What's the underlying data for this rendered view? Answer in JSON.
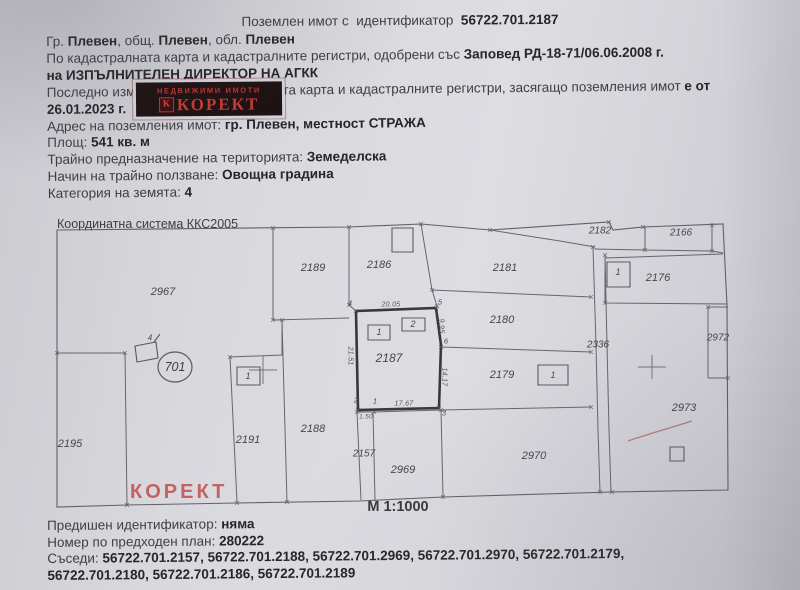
{
  "title": {
    "segments": [
      {
        "t": "Поземлен имот с  идентификатор  ",
        "b": false
      },
      {
        "t": "56722.701.2187",
        "b": true
      }
    ]
  },
  "doc": {
    "lines": [
      [
        {
          "t": "Гр. ",
          "b": false
        },
        {
          "t": "Плевен",
          "b": true
        },
        {
          "t": ", общ. ",
          "b": false
        },
        {
          "t": "Плевен",
          "b": true
        },
        {
          "t": ", обл. ",
          "b": false
        },
        {
          "t": "Плевен",
          "b": true
        }
      ],
      [
        {
          "t": "По кадастралната карта и кадастралните регистри, одобрени със ",
          "b": false
        },
        {
          "t": "Заповед РД-18-71/06.06.2008 г.",
          "b": true
        }
      ],
      [
        {
          "t": "на ИЗПЪЛНИТЕЛЕН ДИРЕКТОР НА АГКК",
          "b": true
        }
      ],
      [
        {
          "t": "Последно изменение на кадастралната карта и кадастралните регистри, засягащо поземления имот ",
          "b": false
        },
        {
          "t": "е от",
          "b": true
        }
      ],
      [
        {
          "t": "26.01.2023 г.",
          "b": true
        }
      ],
      [
        {
          "t": "Адрес на поземления имот: ",
          "b": false
        },
        {
          "t": "гр. Плевен, местност СТРАЖА",
          "b": true
        }
      ],
      [
        {
          "t": "Площ: ",
          "b": false
        },
        {
          "t": "541 кв. м",
          "b": true
        }
      ],
      [
        {
          "t": "Трайно предназначение на територията: ",
          "b": false
        },
        {
          "t": "Земеделска",
          "b": true
        }
      ],
      [
        {
          "t": "Начин на трайно ползване: ",
          "b": false
        },
        {
          "t": "Овощна градина",
          "b": true
        }
      ],
      [
        {
          "t": "Категория на земята: ",
          "b": false
        },
        {
          "t": "4",
          "b": true
        }
      ]
    ]
  },
  "logo": {
    "tagline": "НЕДВИЖИМИ ИМОТИ",
    "brand": "КОРЕКТ",
    "monogram": "К"
  },
  "map": {
    "coord_system": "Координатна система ККС2005",
    "scale_label": "М 1:1000",
    "watermark": "КОРЕКТ",
    "region_number": "701",
    "parcels": [
      {
        "id": "2967"
      },
      {
        "id": "2189"
      },
      {
        "id": "2186"
      },
      {
        "id": "2181"
      },
      {
        "id": "2182"
      },
      {
        "id": "2166"
      },
      {
        "id": "2176"
      },
      {
        "id": "2180"
      },
      {
        "id": "2187"
      },
      {
        "id": "2179"
      },
      {
        "id": "2336"
      },
      {
        "id": "2972"
      },
      {
        "id": "2973"
      },
      {
        "id": "2195"
      },
      {
        "id": "2191"
      },
      {
        "id": "2188"
      },
      {
        "id": "2157"
      },
      {
        "id": "2969"
      },
      {
        "id": "2970"
      }
    ],
    "building_labels": [
      {
        "n": "1"
      },
      {
        "n": "2"
      },
      {
        "n": "1"
      },
      {
        "n": "1"
      },
      {
        "n": "1"
      },
      {
        "n": "4"
      }
    ],
    "vertex_labels": [
      {
        "n": "4"
      },
      {
        "n": "5"
      },
      {
        "n": "6"
      },
      {
        "n": "2"
      },
      {
        "n": "1"
      },
      {
        "n": "3"
      }
    ],
    "dimensions": [
      {
        "v": "20.05"
      },
      {
        "v": "17.67"
      },
      {
        "v": "9.95"
      },
      {
        "v": "14.17"
      },
      {
        "v": "21.51"
      },
      {
        "v": "1.50"
      }
    ]
  },
  "footer": {
    "lines": [
      [
        {
          "t": "Предишен идентификатор: ",
          "b": false
        },
        {
          "t": "няма",
          "b": true
        }
      ],
      [
        {
          "t": "Номер по предходен план: ",
          "b": false
        },
        {
          "t": "280222",
          "b": true
        }
      ],
      [
        {
          "t": "Съседи: ",
          "b": false
        },
        {
          "t": "56722.701.2157, 56722.701.2188, 56722.701.2969, 56722.701.2970, 56722.701.2179,",
          "b": true
        }
      ],
      [
        {
          "t": "56722.701.2180, 56722.701.2186, 56722.701.2189",
          "b": true
        }
      ]
    ]
  },
  "colors": {
    "accent_red": "#c2352e",
    "paper": "#d6d5da",
    "ink": "#3e3e43"
  }
}
